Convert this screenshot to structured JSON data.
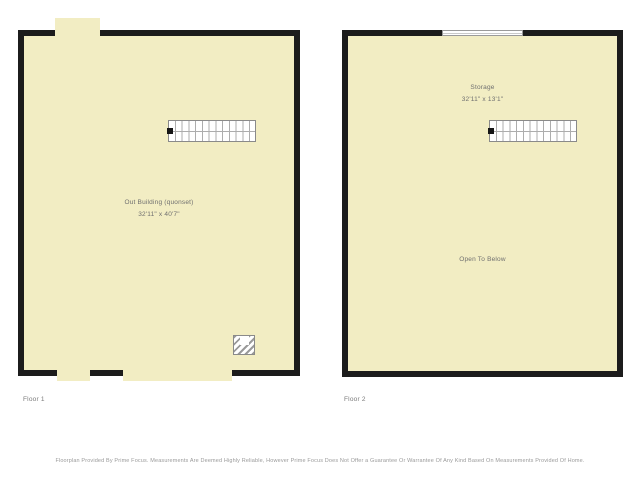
{
  "page": {
    "title": "Floorplan",
    "disclaimer": "Floorplan Provided By Prime Focus. Measurements Are Deemed Highly Reliable, However Prime Focus Does Not Offer a Guarantee Or Warrantee Of Any Kind Based On Measurements Provided Of Home."
  },
  "colors": {
    "floor_fill": "#f2edc3",
    "wall": "#1c1c1c",
    "label_text": "#6f6f6f",
    "caption_text": "#7a7a7a",
    "disclaimer_text": "#9a9a9a",
    "background": "#ffffff"
  },
  "floors": [
    {
      "label": "Floor 1",
      "room": {
        "name": "Out Building (quonset)",
        "dimensions": "32'11\" x 40'7\""
      },
      "features": [
        "stairs-symbol",
        "furnace-hatched-symbol",
        "door-opening-top",
        "door-opening-bottom-small",
        "door-opening-bottom-large"
      ]
    },
    {
      "label": "Floor 2",
      "room": {
        "name": "Storage",
        "dimensions": "32'11\" x 13'1\""
      },
      "note": "Open To Below",
      "features": [
        "stairs-symbol",
        "window-symbol-top"
      ]
    }
  ]
}
